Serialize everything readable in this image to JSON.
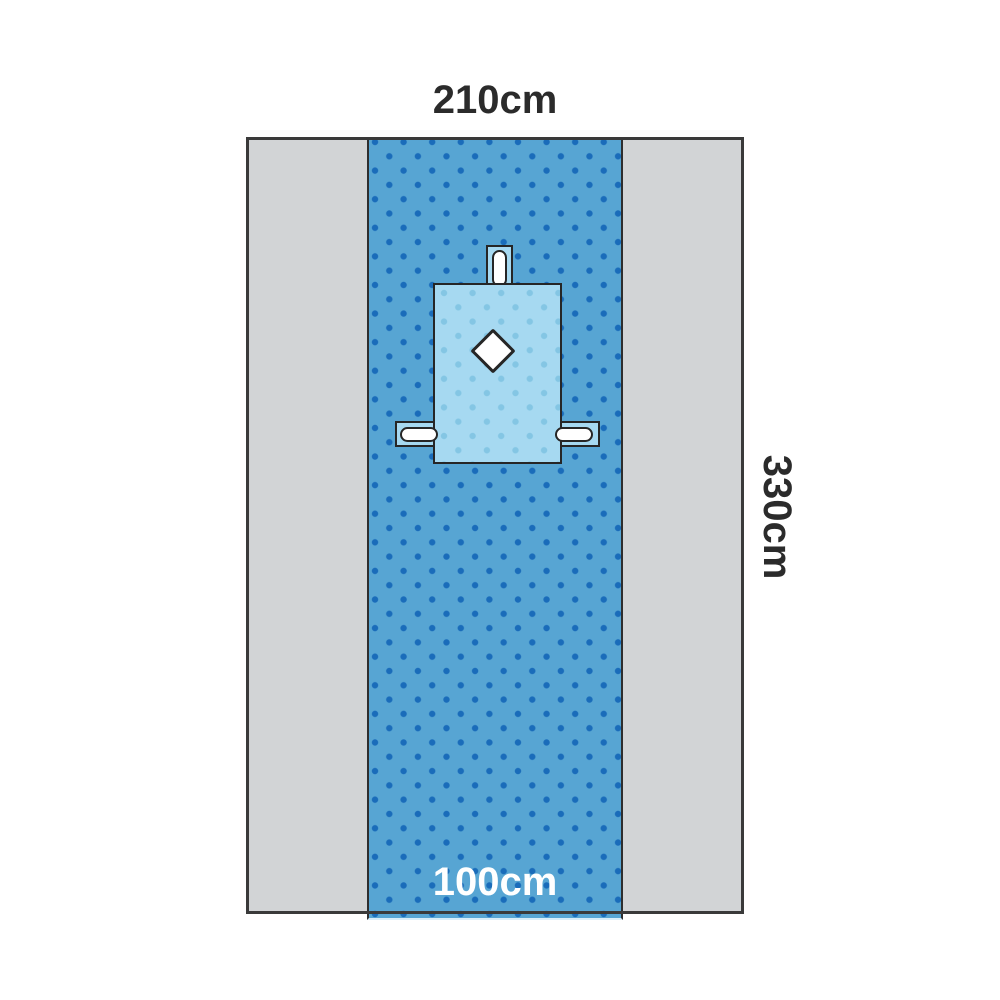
{
  "diagram": {
    "subject": "surgical-drape-dimension-diagram",
    "labels": {
      "top_width": "210cm",
      "side_height": "330cm",
      "strip_width": "100cm"
    },
    "colors": {
      "background": "#ffffff",
      "drape-gray": "#d2d4d6",
      "outline": "#3a3a3a",
      "strip-blue": "#57a5d3",
      "strip-dot": "#1a6cba",
      "pad-blue": "#a6d9f1",
      "pad-dot": "#84c6e4",
      "text-dark": "#2b2b2b",
      "text-light": "#ffffff"
    }
  }
}
